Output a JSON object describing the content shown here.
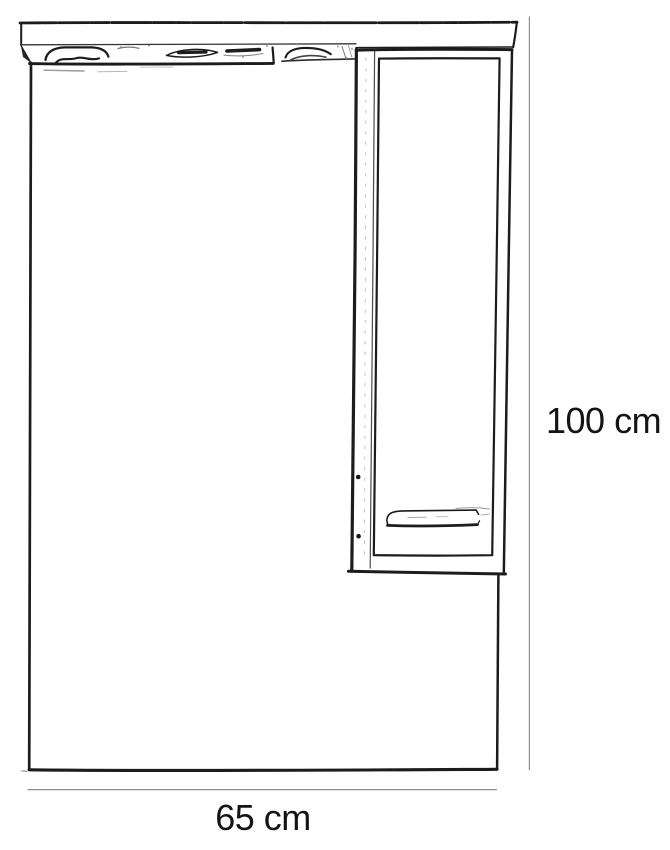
{
  "dimensions": {
    "height": {
      "label": "100 cm",
      "value": 100,
      "unit": "cm"
    },
    "width": {
      "label": "65 cm",
      "value": 65,
      "unit": "cm"
    }
  },
  "style": {
    "ink_color": "#1c1c1c",
    "faint_ink_color": "#8f8f8f",
    "background_color": "#ffffff",
    "label_color": "#141414"
  }
}
